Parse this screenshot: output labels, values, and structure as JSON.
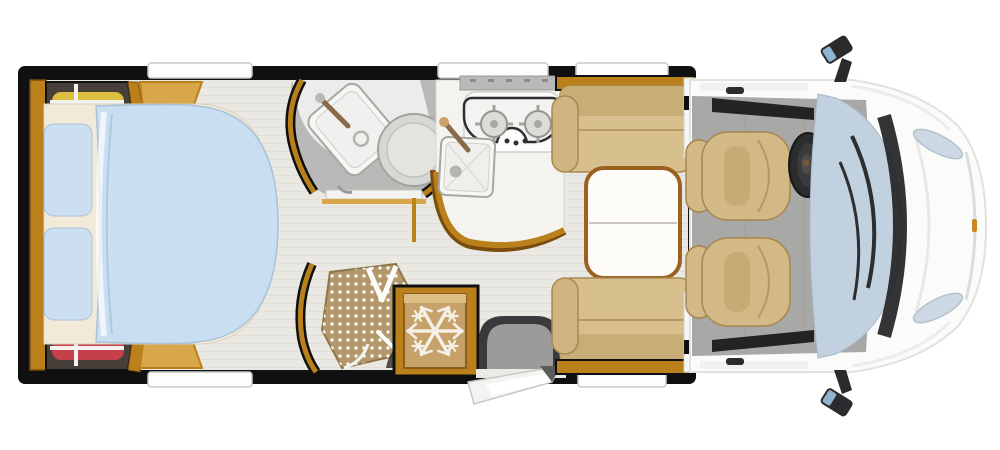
{
  "scene": {
    "name": "Motorhome floor plan, top view",
    "type": "floorplan-illustration",
    "background": "#ffffff"
  },
  "colors": {
    "bg": "#ffffff",
    "wall": "#101010",
    "wood": "#b9801c",
    "woodLight": "#d8a64b",
    "woodDark": "#7a4d0e",
    "floor": "#eae8e3",
    "plankLine": "#d9d5cc",
    "cabFloor": "#a8a8a6",
    "bathFloor": "#b9b9b7",
    "bathWhite": "#ececea",
    "fixture": "#f6f6f4",
    "fixtureEdge": "#a6a6a2",
    "toilet": "#d7d7d3",
    "toiletRing": "#b3b3af",
    "duvet": "#c9def1",
    "duvetEdge": "#a9c2da",
    "pillow": "#cbdff1",
    "sheet": "#f2ead9",
    "cushion": "#d7bf8e",
    "cushionShade": "#c9ad77",
    "cushionEdge": "#a8894f",
    "table": "#fdfcf8",
    "tableRim": "#9a6120",
    "tableLine": "#c9c6c0",
    "fridgeFace": "#c6a26a",
    "fridgeHighlight": "#dcbd84",
    "snow": "#f4f0e6",
    "mat": "#9b9b99",
    "matEdge": "#3a3a3c",
    "showerTray": "#b2986b",
    "showerDot": "#f7f4ec",
    "clothYellow": "#ddbe3e",
    "clothRed": "#c5404a",
    "clothBlue": "#a2bdd9",
    "rail": "#f2f2f0",
    "wardrobe": "#473f39",
    "cabBody": "#fbfbfa",
    "cabEdge": "#e1e1df",
    "windshield": "#c2d1e0",
    "windshieldEdge": "#a8bac9",
    "trim": "#232325",
    "glassLight": "#ccd9e4",
    "seat": "#d3b985",
    "seatEdge": "#a8854e",
    "seatChannel": "#c7ab74",
    "mirrorGlass": "#8fb4d2",
    "steel": "#b9b9b5",
    "faucet": "#8a6a49",
    "hobEdge": "#2f2f31",
    "burner": "#dcdcd8",
    "burnerLine": "#a4a4a0",
    "amber": "#c8871f",
    "windowStrip": "#fdfdfd",
    "windowEdge": "#c9c9c7",
    "doorWhite": "#f3f3f1",
    "doorEdge": "#c7c7c3"
  },
  "inventory": {
    "rooms": [
      {
        "id": "bedroom",
        "label": "rear bedroom with island bed"
      },
      {
        "id": "bathroom",
        "label": "washroom with basin and toilet"
      },
      {
        "id": "shower",
        "label": "separate shower cubicle"
      },
      {
        "id": "kitchen",
        "label": "kitchen with hob and sink"
      },
      {
        "id": "dinette",
        "label": "face-to-face dinette with table"
      },
      {
        "id": "entry",
        "label": "habitation entry door with step"
      },
      {
        "id": "cab",
        "label": "driver cab"
      }
    ],
    "features": [
      {
        "id": "wardrobe-top",
        "label": "wardrobe with yellow and red clothes"
      },
      {
        "id": "wardrobe-bottom",
        "label": "wardrobe with blue and red clothes"
      },
      {
        "id": "island-bed",
        "label": "island bed with two pillows and duvet"
      },
      {
        "id": "washbasin",
        "label": "corner washbasin"
      },
      {
        "id": "toilet",
        "label": "swivel toilet"
      },
      {
        "id": "shower-tray",
        "label": "mosaic shower tray with glass door"
      },
      {
        "id": "hob",
        "label": "two-burner gas hob",
        "burners": 2
      },
      {
        "id": "kitchen-sink",
        "label": "square kitchen sink"
      },
      {
        "id": "refrigerator",
        "label": "refrigerator marked with snowflake"
      },
      {
        "id": "entry-step",
        "label": "entry step mat with open door"
      },
      {
        "id": "dinette-table",
        "label": "two-leaf dinette table"
      },
      {
        "id": "dinette-benches",
        "label": "facing bench seats",
        "count": 2
      },
      {
        "id": "cab-seats",
        "label": "swivel captain seats",
        "count": 2
      },
      {
        "id": "steering-wheel",
        "label": "steering wheel"
      },
      {
        "id": "windshield",
        "label": "windshield with wipers"
      },
      {
        "id": "side-mirrors",
        "label": "side mirrors",
        "count": 2
      },
      {
        "id": "headlights",
        "label": "headlights",
        "count": 2
      },
      {
        "id": "roof-windows",
        "label": "wall/roof window strips",
        "count": 5
      }
    ]
  }
}
